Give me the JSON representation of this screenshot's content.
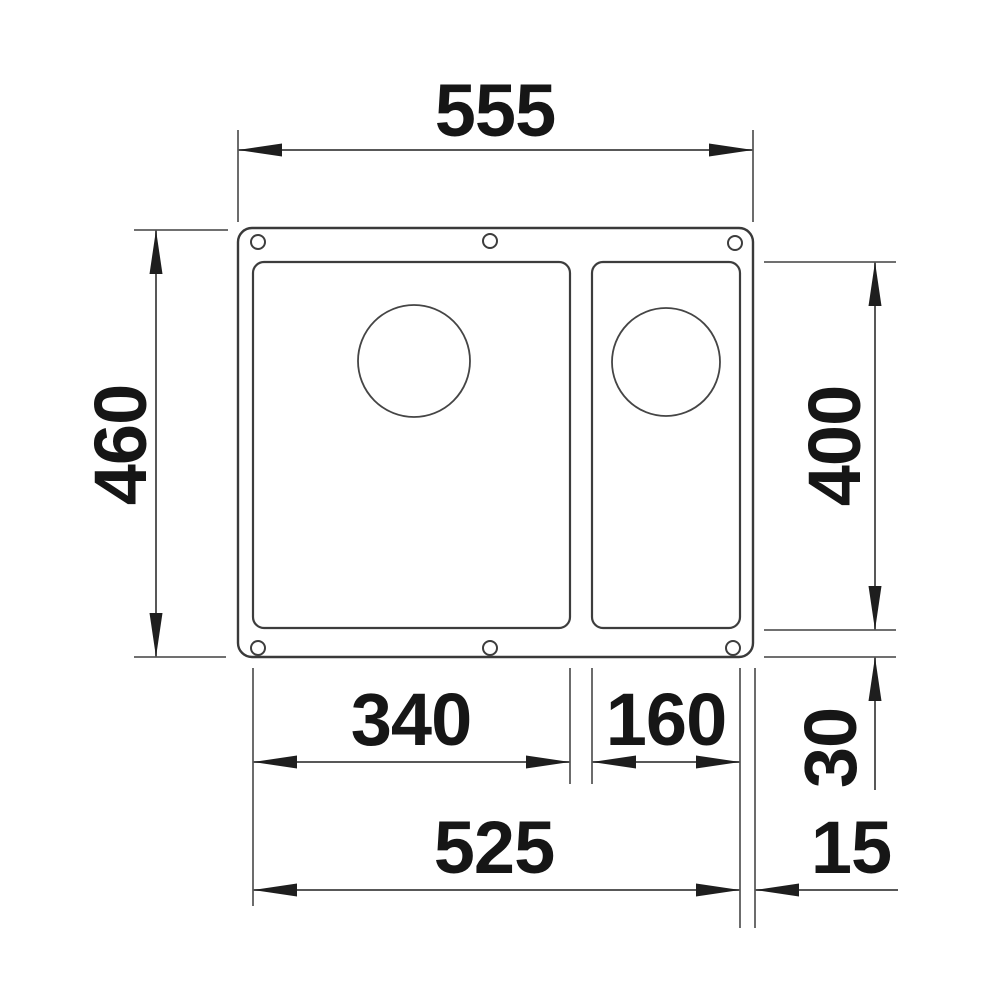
{
  "drawing": {
    "kind": "technical-dimension-drawing",
    "subject": "undermount one-and-a-half bowl sink, top view",
    "dimensions": {
      "overall_width": "555",
      "overall_depth": "460",
      "bowl_depth": "400",
      "main_bowl_width": "340",
      "half_bowl_width": "160",
      "bottom_rim": "30",
      "cutout_width": "525",
      "edge_gap": "15"
    }
  }
}
